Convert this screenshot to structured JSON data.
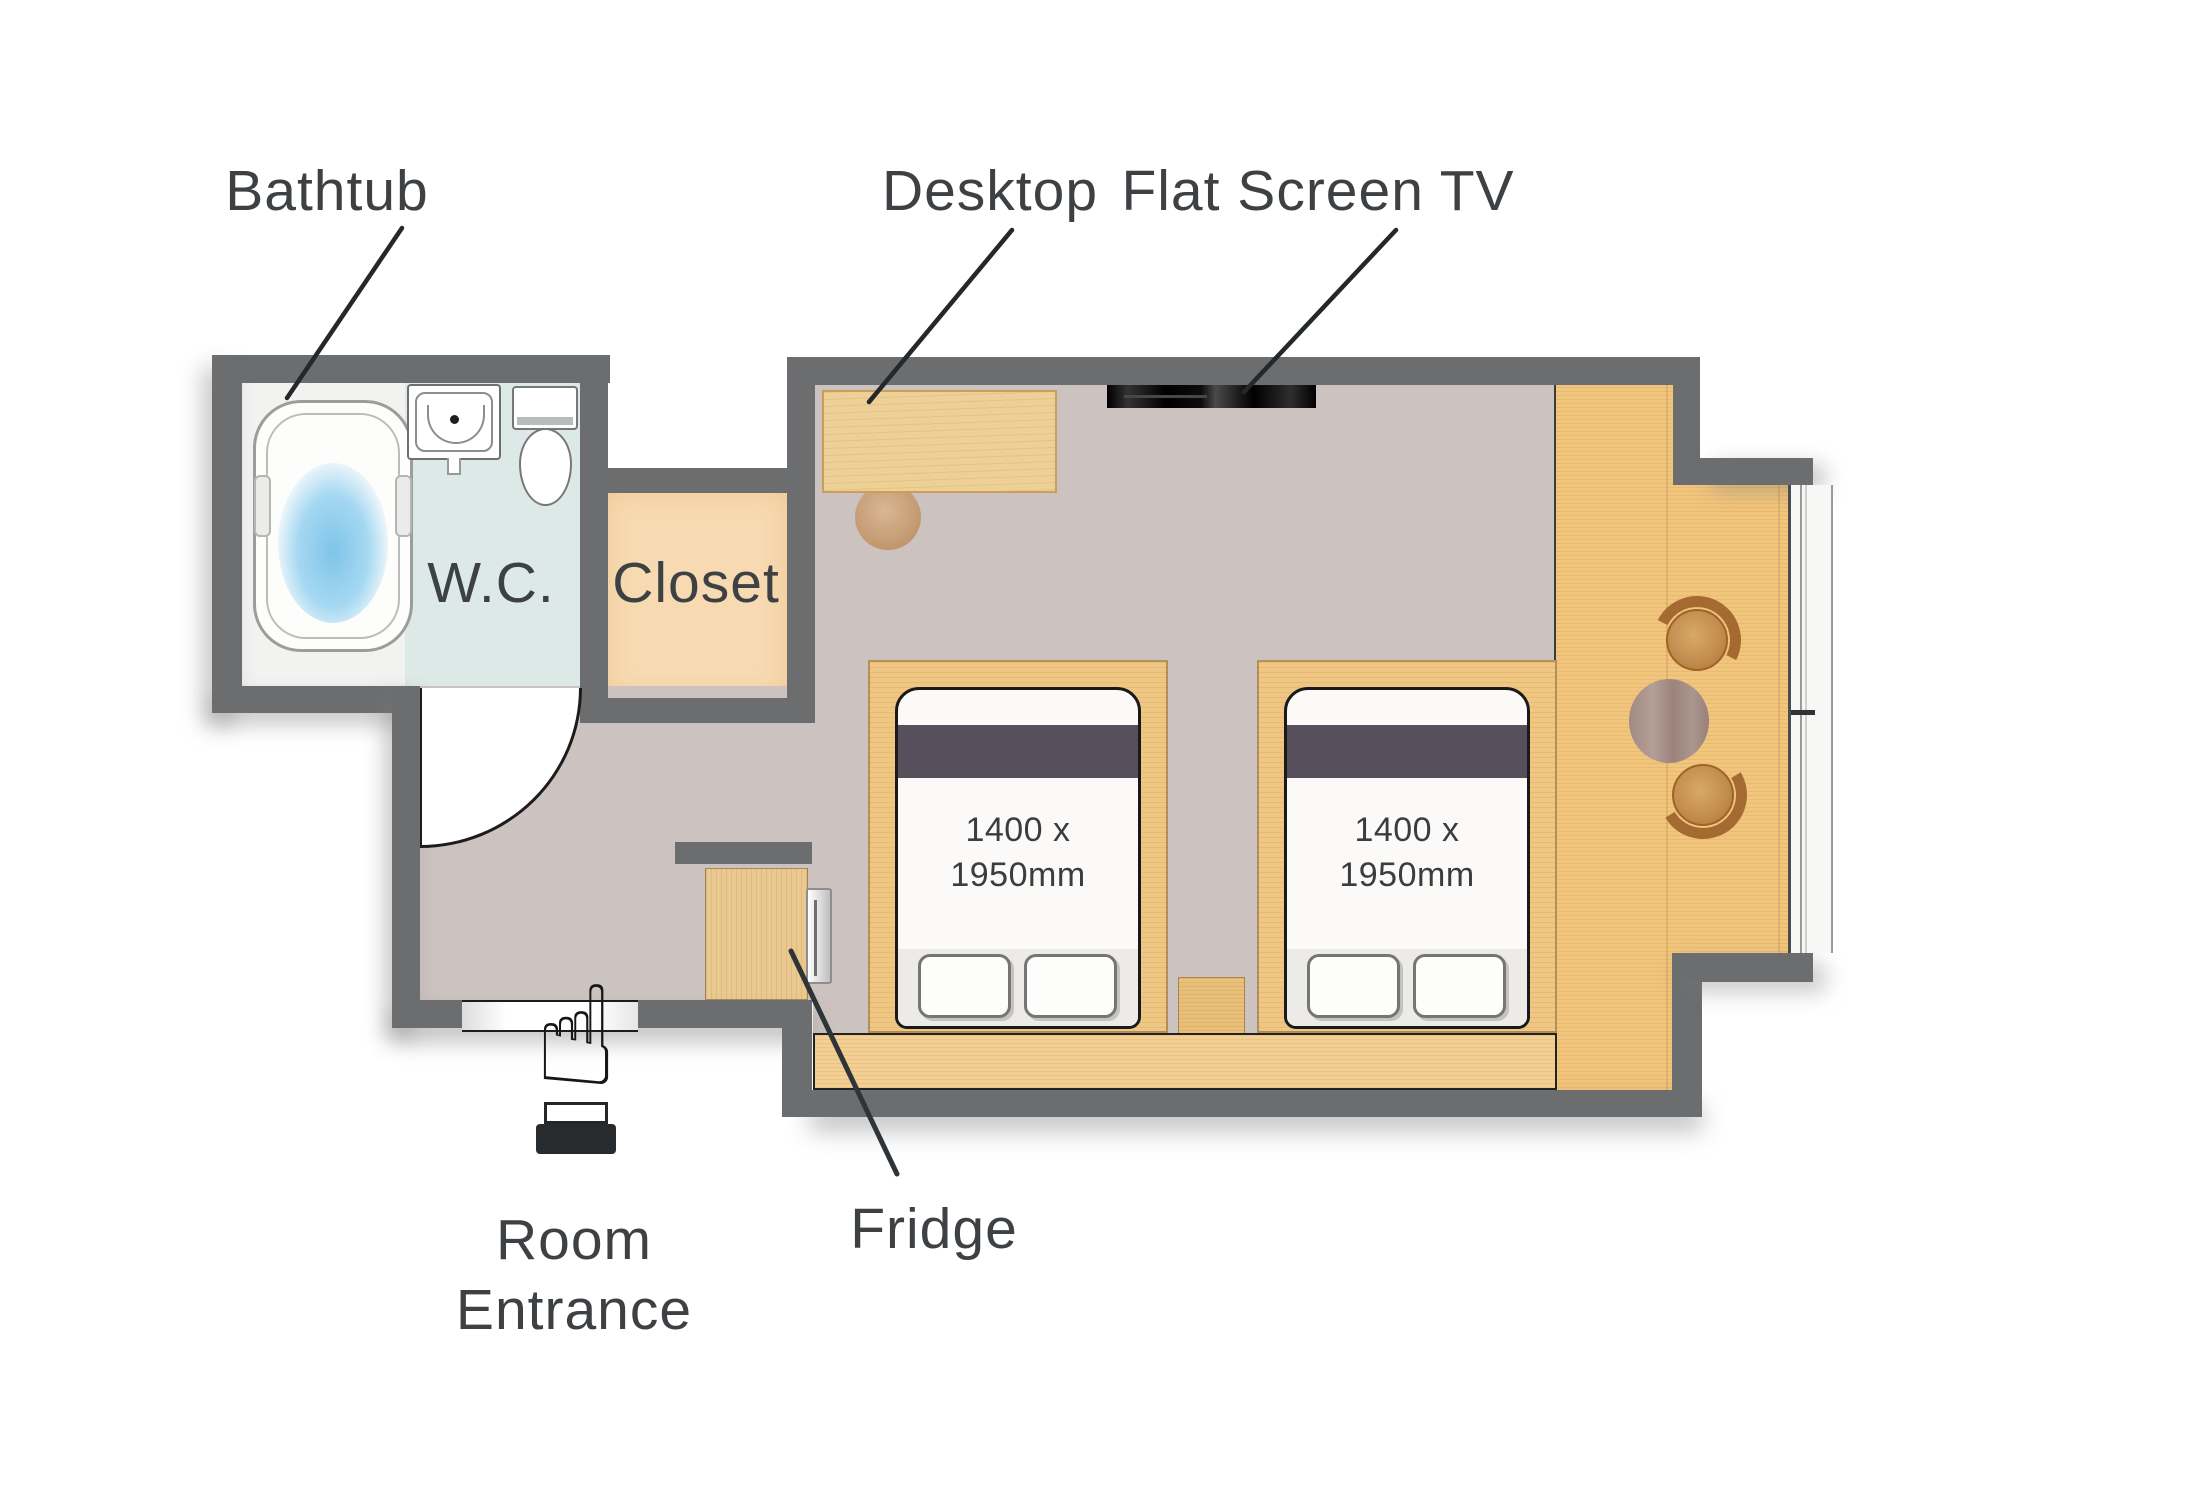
{
  "labels": {
    "bathtub": "Bathtub",
    "desktop": "Desktop",
    "flat_screen_tv": "Flat Screen TV",
    "wc": "W.C.",
    "closet": "Closet",
    "fridge": "Fridge",
    "room_entrance_line1": "Room",
    "room_entrance_line2": "Entrance"
  },
  "beds": {
    "dimension_line1": "1400 x",
    "dimension_line2": "1950mm"
  },
  "entrance": {
    "pointer_glyph": "☝"
  },
  "icons": {
    "entrance_pointer": "pointing-hand-icon",
    "door_swing": "door-swing-arc",
    "window": "window-glazing"
  },
  "colors": {
    "wall": "#6b6d6f",
    "floor_main": "#ccc3c0",
    "floor_bath": "#f2f2f0",
    "floor_wc": "#dce9e6",
    "floor_closet": "#f7dab2",
    "wood": "#f0c683",
    "wood_bench": "#f3cf93",
    "wood_nook": "#f2c57d",
    "wood_cabinet": "#e9c98f",
    "wood_desk": "#ecd096",
    "band": "#57505c",
    "text": "#3e4144",
    "water": "#7fc4e8",
    "table": "#a8908a",
    "chair": "#c28b4e",
    "chair_dark": "#a46a31",
    "line": "#24282b"
  }
}
